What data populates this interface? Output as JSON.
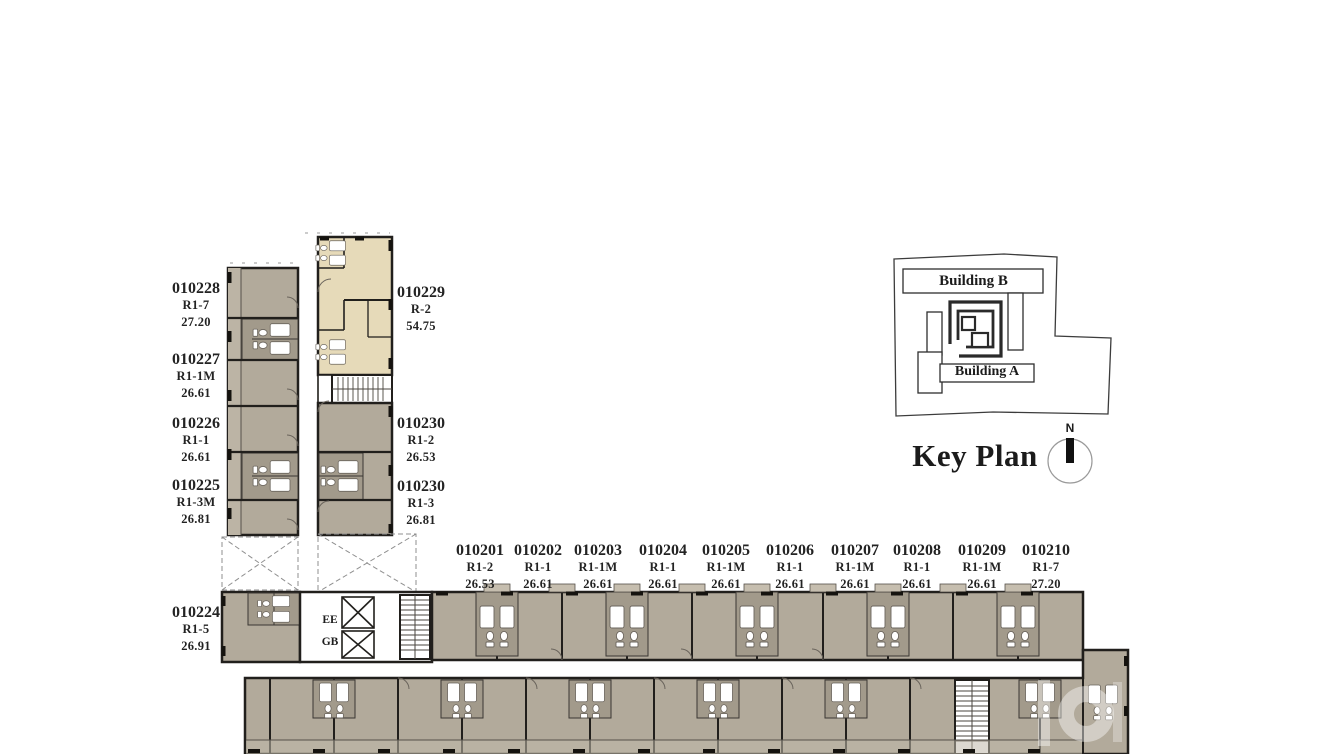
{
  "units": {
    "left_wing": [
      {
        "id": "010228",
        "type": "R1-7",
        "area": "27.20"
      },
      {
        "id": "010227",
        "type": "R1-1M",
        "area": "26.61"
      },
      {
        "id": "010226",
        "type": "R1-1",
        "area": "26.61"
      },
      {
        "id": "010225",
        "type": "R1-3M",
        "area": "26.81"
      },
      {
        "id": "010224",
        "type": "R1-5",
        "area": "26.91"
      }
    ],
    "right_wing": [
      {
        "id": "010229",
        "type": "R-2",
        "area": "54.75"
      },
      {
        "id": "010230",
        "type": "R1-2",
        "area": "26.53"
      },
      {
        "id": "010230",
        "type": "R1-3",
        "area": "26.81"
      }
    ],
    "bottom_wing": [
      {
        "id": "010201",
        "type": "R1-2",
        "area": "26.53"
      },
      {
        "id": "010202",
        "type": "R1-1",
        "area": "26.61"
      },
      {
        "id": "010203",
        "type": "R1-1M",
        "area": "26.61"
      },
      {
        "id": "010204",
        "type": "R1-1",
        "area": "26.61"
      },
      {
        "id": "010205",
        "type": "R1-1M",
        "area": "26.61"
      },
      {
        "id": "010206",
        "type": "R1-1",
        "area": "26.61"
      },
      {
        "id": "010207",
        "type": "R1-1M",
        "area": "26.61"
      },
      {
        "id": "010208",
        "type": "R1-1",
        "area": "26.61"
      },
      {
        "id": "010209",
        "type": "R1-1M",
        "area": "26.61"
      },
      {
        "id": "010210",
        "type": "R1-7",
        "area": "27.20"
      }
    ]
  },
  "core": {
    "elevator_label": "EE",
    "garbage_label": "GB"
  },
  "key_plan": {
    "title": "Key Plan",
    "building_b": "Building B",
    "building_a": "Building A",
    "north": "N"
  },
  "colors": {
    "unit_fill": "#b2aa9b",
    "unit_fill_dark": "#a29a8b",
    "balcony_fill": "#c0b8a9",
    "highlight_unit_fill": "#e6dab9",
    "wall": "#211f1c",
    "background": "#ffffff"
  }
}
